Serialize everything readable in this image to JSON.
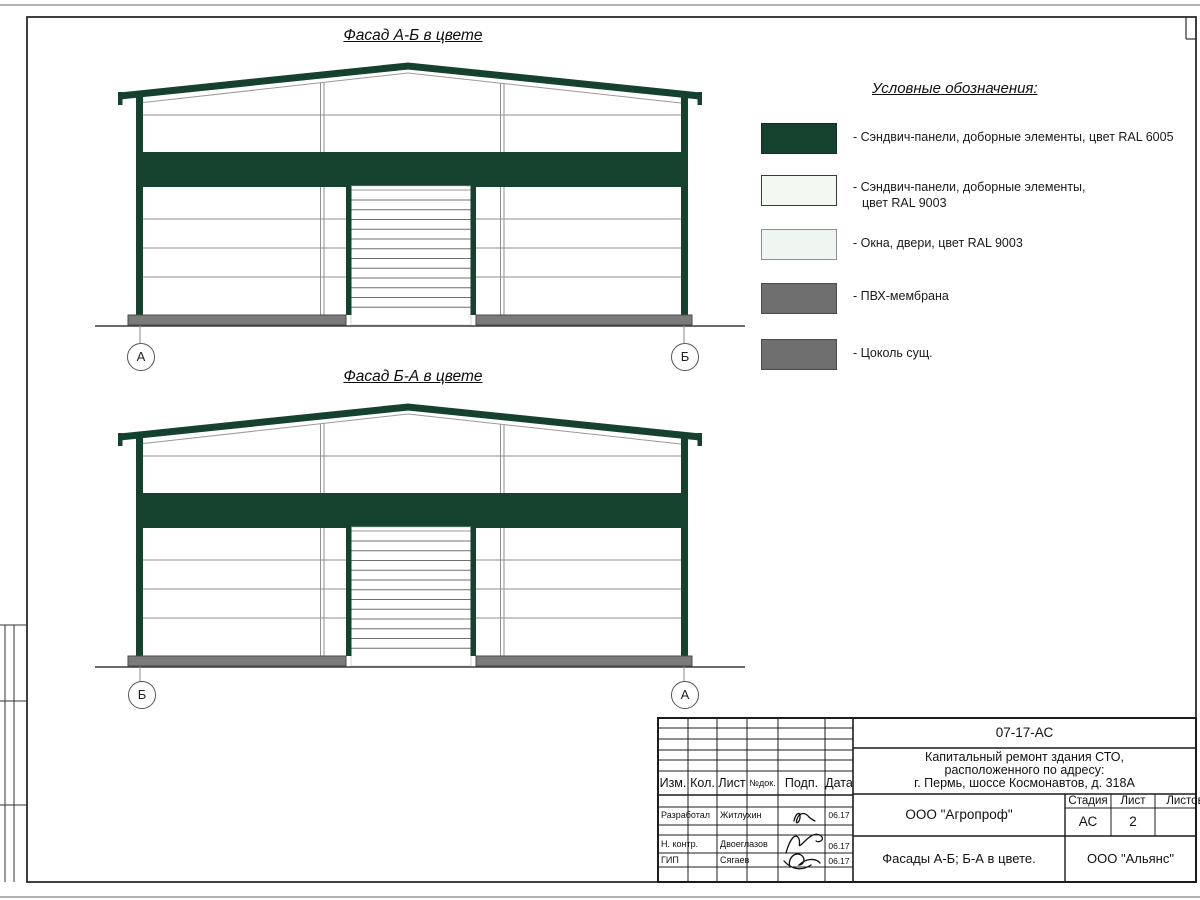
{
  "sheet": {
    "facades": [
      {
        "title": "Фасад А-Б в цвете",
        "axis_left": "А",
        "axis_right": "Б"
      },
      {
        "title": "Фасад Б-А в цвете",
        "axis_left": "Б",
        "axis_right": "А"
      }
    ],
    "legend": {
      "title": "Условные обозначения:",
      "items": [
        {
          "lines": [
            "- Сэндвич-панели, доборные элементы,  цвет RAL 6005"
          ],
          "fill": "#15412f",
          "border": "#0e2f23"
        },
        {
          "lines": [
            "- Сэндвич-панели, доборные элементы,",
            "цвет RAL 9003"
          ],
          "fill": "#f4f8f3",
          "border": "#3a3a3a"
        },
        {
          "lines": [
            "- Окна, двери, цвет RAL 9003"
          ],
          "fill": "#eff5f0",
          "border": "#8f8f8f"
        },
        {
          "lines": [
            "- ПВХ-мембрана"
          ],
          "fill": "#6e6e6e",
          "border": "#4a4a4a"
        },
        {
          "lines": [
            "- Цоколь сущ."
          ],
          "fill": "#6e6e6e",
          "border": "#4a4a4a"
        }
      ]
    },
    "titleblock": {
      "doc_code": "07-17-АС",
      "project": [
        "Капитальный ремонт здания СТО,",
        "расположенного по адресу:",
        "г. Пермь, шоссе Космонавтов, д. 318А"
      ],
      "org": "ООО \"Агропроф\"",
      "stage_label": "Стадия",
      "sheet_label": "Лист",
      "sheets_label": "Листов",
      "stage": "АС",
      "sheet_no": "2",
      "sheets_total": "",
      "drawing_title": "Фасады А-Б; Б-А в цвете.",
      "company": "ООО \"Альянс\"",
      "columns": [
        "Изм.",
        "Кол.",
        "Лист",
        "№док.",
        "Подп.",
        "Дата"
      ],
      "signature_rows": [
        {
          "role": "Разработал",
          "name": "Житлухин",
          "date": "06.17"
        },
        {
          "role": "Н. контр.",
          "name": "Двоеглазов",
          "date": "06.17"
        },
        {
          "role": "ГИП",
          "name": "Сягаев",
          "date": "06.17"
        }
      ]
    },
    "colors": {
      "green": "#15412f",
      "plinth": "#7b7b7b",
      "line": "#8f8f8f",
      "ground": "#3c3c3c"
    }
  }
}
